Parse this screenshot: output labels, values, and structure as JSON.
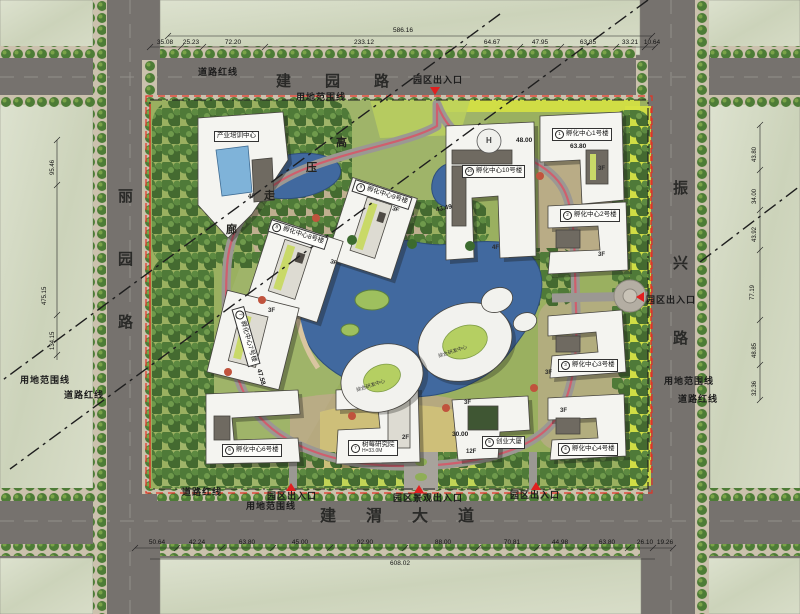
{
  "roads": {
    "top": "建园路",
    "bottom": "建渭大道",
    "left": "丽园路",
    "right": "振兴路"
  },
  "boundary": {
    "red": "道路红线",
    "land": "用地范围线"
  },
  "entrances": {
    "gate": "园区出入口",
    "landscape": "园区景观出入口"
  },
  "corridor": {
    "c0": "高",
    "c1": "压",
    "c2": "走",
    "c3": "廊"
  },
  "buildings": [
    {
      "num": "",
      "name": "产业培训中心"
    },
    {
      "num": "9",
      "name": "孵化中心9号楼"
    },
    {
      "num": "8",
      "name": "孵化中心8号楼"
    },
    {
      "num": "10",
      "name": "孵化中心10号楼"
    },
    {
      "num": "1",
      "name": "孵化中心1号楼"
    },
    {
      "num": "2",
      "name": "孵化中心2号楼"
    },
    {
      "num": "3",
      "name": "孵化中心3号楼"
    },
    {
      "num": "4",
      "name": "孵化中心4号楼"
    },
    {
      "num": "5",
      "name": "创业大厦"
    },
    {
      "num": "7",
      "name": "树莓研究院",
      "note": "H=33.0M"
    },
    {
      "num": "6",
      "name": "孵化中心6号楼"
    },
    {
      "num": "7",
      "name": "孵化中心7号楼"
    },
    {
      "num": "",
      "name": "综合研发中心"
    }
  ],
  "floors": [
    "3F",
    "3F",
    "3F",
    "3F",
    "4F",
    "3F",
    "12F",
    "2F",
    "3F",
    "3F",
    "3F",
    "4F"
  ],
  "plan_numbers": [
    "63.80",
    "48.00",
    "43.49",
    "30.00",
    "47.58"
  ],
  "misc": {
    "helipad": "H"
  },
  "dims": {
    "top": {
      "total": "586.16",
      "segments": [
        "35.08",
        "25.23",
        "72.20",
        "233.12",
        "64.67",
        "47.95",
        "63.85",
        "33.21",
        "10.64"
      ]
    },
    "bottom": {
      "total": "608.02",
      "segments": [
        "50.64",
        "42.24",
        "63.80",
        "45.00",
        "92.90",
        "88.00",
        "70.81",
        "44.98",
        "63.80",
        "26.10",
        "19.26"
      ]
    },
    "left": [
      "95.46",
      "475.15",
      "134.15"
    ],
    "right": [
      "43.80",
      "34.00",
      "43.92",
      "77.19",
      "48.85",
      "32.36"
    ]
  }
}
